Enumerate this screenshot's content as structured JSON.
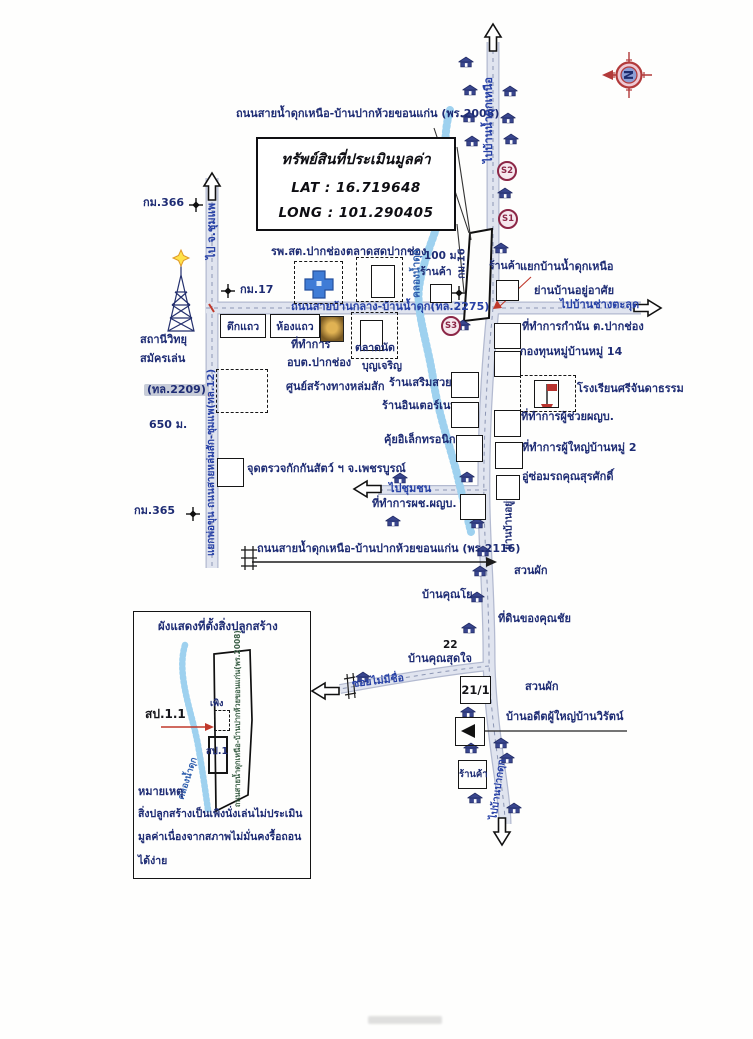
{
  "title_block": {
    "title": "ทรัพย์สินที่ประเมินมูลค่า",
    "lat": "LAT : 16.719648",
    "long": "LONG : 101.290405"
  },
  "compass": {
    "letter": "N"
  },
  "roads": {
    "top": "ถนนสายน้ำดุกเหนือ-บ้านปากห้วยขอนแก่น (พร.2008)",
    "main": "ถนนสายบ้านกลาง-บ้านน้ำดุก(ทล.2275)",
    "south": "ถนนสายน้ำดุกเหนือ-บ้านปากห้วยขอนแก่น (พร.2116)",
    "left_vertical": "แยกพ่อขุน ถนนสายหล่มสัก-ชุมแพ(ทล.12)",
    "hw2209": "(ทล.2209)",
    "to_chumphae": "ไป จ.ชุมแพ",
    "to_namduk_nuea": "ไปบ้านน้ำดุกเหนือ",
    "to_changtalut": "ไปบ้านช่างตะลุด",
    "to_community": "ไปชุมชน",
    "to_pakduk": "ไปบ้านปากดุก",
    "soi_unnamed": "ซอยไม่มีชื่อ",
    "residential_v": "ย่านบ้านอยู่อาศัย",
    "canal": "คลองน้ำดุก"
  },
  "markers": {
    "s1": "S1",
    "s2": "S2",
    "s3": "S3",
    "km366": "กม.366",
    "km17": "กม.17",
    "km365": "กม.365",
    "km16": "กม.16",
    "d100": "100 ม.",
    "d650": "650 ม.",
    "n22": "22",
    "n211": "21/1"
  },
  "places": {
    "hospital": "รพ.สต.ปากช่อง",
    "fresh_market": "ตลาดสดปากช่อง",
    "shop_w": "ร้านค้า",
    "shop_e": "ร้านค้า",
    "junction": "แยกบ้านน้ำดุกเหนือ",
    "residential": "ย่านบ้านอยู่อาศัย",
    "shophouse": "ตึกแถว",
    "rowhouse": "ห้องแถว",
    "office_line1": "ที่ทำการ",
    "office_line2": "อบต.ปากช่อง",
    "flea_line1": "ตลาดนัด",
    "flea_line2": "บุญเจริญ",
    "road_center": "ศูนย์สร้างทางหล่มสัก",
    "radio_line1": "สถานีวิทยุ",
    "radio_line2": "สมัครเล่น",
    "beauty": "ร้านเสริมสวย",
    "internet": "ร้านอินเตอร์เนท",
    "electronics": "คุ้ยอิเล็กทรอนิก",
    "quarantine": "จุดตรวจกักกันสัตว์ ฯ จ.เพชรบูรณ์",
    "asst_office": "ที่ทำการผช.ผญบ.",
    "kamnan": "ที่ทำการกำนัน ต.ปากช่อง",
    "fund": "กองทุนหมู่บ้านหมู่ 14",
    "school": "โรงเรียนศรีจันดาธรรม",
    "asst_headman": "ที่ทำการผู้ช่วยผญบ.",
    "headman2": "ที่ทำการผู้ใหญ่บ้านหมู่ 2",
    "garage": "อู่ซ่อมรถคุณสุรศักดิ์",
    "veg1": "สวนผัก",
    "veg2": "สวนผัก",
    "ban_yo": "บ้านคุณโย",
    "chai_land": "ที่ดินของคุณชัย",
    "ban_sutjai": "บ้านคุณสุดใจ",
    "former_headman": "บ้านอดีตผู้ใหญ่บ้านวิรัตน์",
    "shop_s": "ร้านค้า"
  },
  "inset": {
    "title": "ผังแสดงที่ตั้งสิ่งปลูกสร้าง",
    "sp11": "สป.1.1",
    "shed": "เพิง",
    "sp1": "สป.1",
    "canal": "คลองน้ำดุก",
    "road_v": "ถนนสายน้ำดุกเหนือ-บ้านปากห้วยขอนแก่น(พร.2008)",
    "note_head": "หมายเหตุ",
    "note1": "สิ่งปลูกสร้างเป็นเพิงนั่งเล่นไม่ประเมิน",
    "note2": "มูลค่าเนื่องจากสภาพไม่มั่นคงรื้อถอน",
    "note3": "ได้ง่าย"
  },
  "icons": {
    "left_arrow": "◄"
  },
  "map_marks": {
    "houses": [
      [
        466,
        62
      ],
      [
        470,
        90
      ],
      [
        469,
        117
      ],
      [
        472,
        141
      ],
      [
        510,
        91
      ],
      [
        508,
        118
      ],
      [
        511,
        139
      ],
      [
        505,
        193
      ],
      [
        501,
        248
      ],
      [
        463,
        325
      ],
      [
        400,
        478
      ],
      [
        467,
        477
      ],
      [
        393,
        521
      ],
      [
        477,
        523
      ],
      [
        483,
        551
      ],
      [
        480,
        571
      ],
      [
        477,
        597
      ],
      [
        469,
        628
      ],
      [
        363,
        677
      ],
      [
        468,
        712
      ],
      [
        471,
        748
      ],
      [
        501,
        743
      ],
      [
        507,
        758
      ],
      [
        475,
        798
      ],
      [
        514,
        808
      ]
    ]
  },
  "colors": {
    "label_navy": "#1e2c74",
    "road_label_blue": "#2741a6",
    "road_fill": "#e0e4ef",
    "road_edge": "#b3bad0",
    "road_dash": "#8c96b4",
    "stream_blue": "#9ed1ef",
    "red": "#b23a3a",
    "marker_maroon": "#8c2747"
  }
}
